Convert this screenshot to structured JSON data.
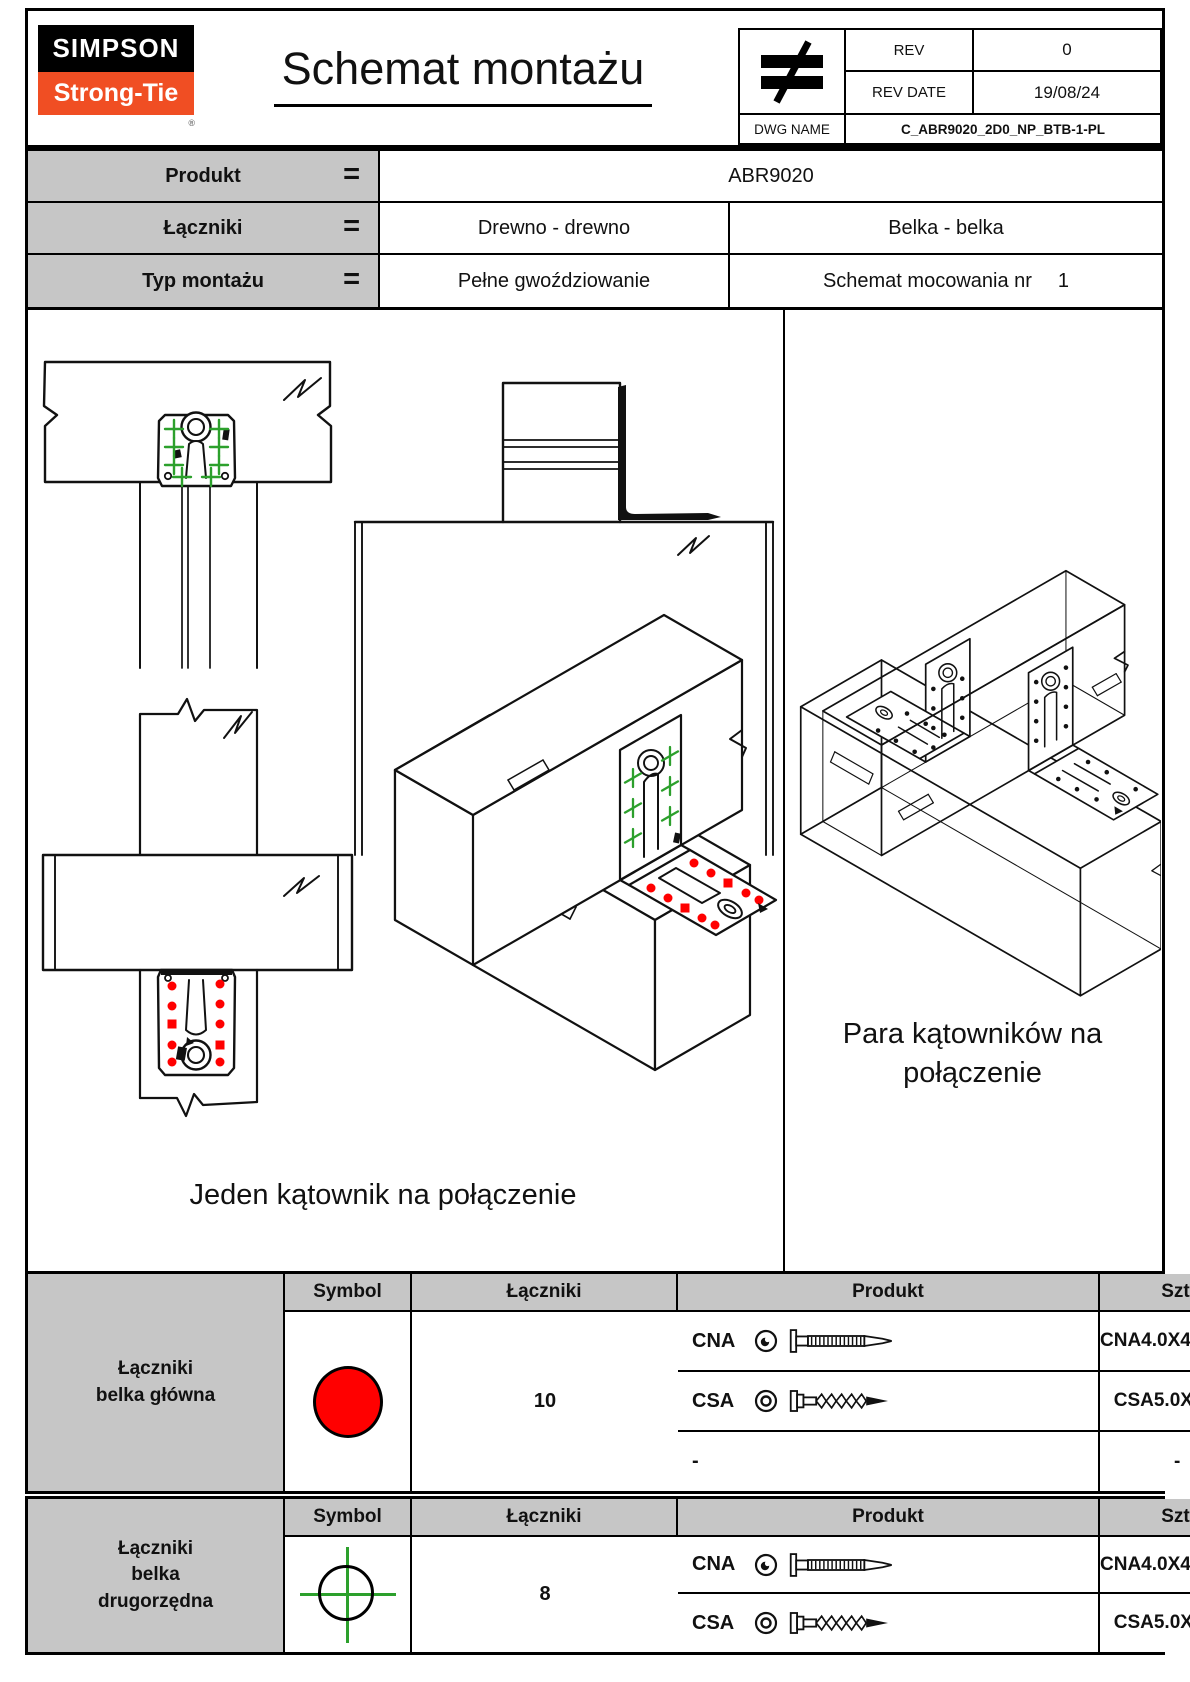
{
  "header": {
    "logo_line1": "SIMPSON",
    "logo_line2": "Strong-Tie",
    "logo_reg": "®",
    "title": "Schemat montażu",
    "rev_table": {
      "rev_label": "REV",
      "rev_value": "0",
      "rev_date_label": "REV DATE",
      "rev_date_value": "19/08/24",
      "dwg_label": "DWG NAME",
      "dwg_value": "C_ABR9020_2D0_NP_BTB-1-PL"
    }
  },
  "product_info": {
    "rows": [
      {
        "label": "Produkt",
        "eq": "=",
        "value": "ABR9020"
      },
      {
        "label": "Łączniki",
        "eq": "=",
        "value_left": "Drewno - drewno",
        "value_right": "Belka - belka"
      },
      {
        "label": "Typ montażu",
        "eq": "=",
        "value_left": "Pełne gwoździowanie",
        "value_right": "Schemat mocowania nr",
        "value_right_number": "1"
      }
    ]
  },
  "drawings": {
    "left_caption": "Jeden kątownik na połączenie",
    "right_caption": "Para kątowników na\npołączenie"
  },
  "fastener_tables": [
    {
      "group_label": "Łączniki\nbelka główna",
      "col_symbol": "Symbol",
      "col_fasteners": "Łączniki",
      "col_product": "Produkt",
      "col_qty": "Szt.",
      "symbol_icon": "red-filled-circle",
      "rows": [
        {
          "code": "CNA",
          "icon": "ring-shank-nail",
          "product": "CNA4.0X40/50/60"
        },
        {
          "code": "CSA",
          "icon": "wood-screw",
          "product": "CSA5.0X40/50"
        },
        {
          "code": "-",
          "icon": "",
          "product": "-"
        }
      ],
      "qty": "10"
    },
    {
      "group_label": "Łączniki\nbelka\ndrugorzędna",
      "col_symbol": "Symbol",
      "col_fasteners": "Łączniki",
      "col_product": "Produkt",
      "col_qty": "Szt.",
      "symbol_icon": "green-crosshair-circle",
      "rows": [
        {
          "code": "CNA",
          "icon": "ring-shank-nail",
          "product": "CNA4.0X40/50/60"
        },
        {
          "code": "CSA",
          "icon": "wood-screw",
          "product": "CSA5.0X40/50"
        }
      ],
      "qty": "8"
    }
  ],
  "colors": {
    "brand_orange": "#f04e23",
    "marker_red": "#ff0000",
    "marker_green": "#2ca02c",
    "cell_gray": "#c6c6c6"
  }
}
